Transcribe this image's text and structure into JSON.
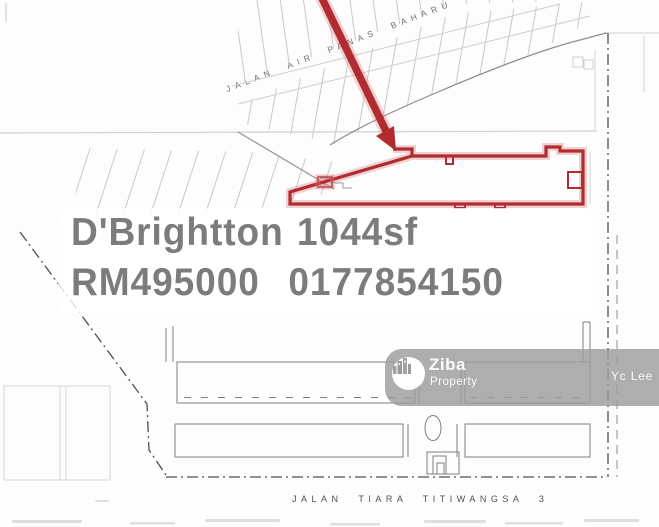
{
  "listing": {
    "name": "D'Brightton",
    "size": "1044sf",
    "price": "RM495000",
    "phone": "0177854150"
  },
  "streets": {
    "top": "JALAN AIR PANAS BAHARU",
    "bottom": "JALAN TIARA TITIWANGSA 3"
  },
  "watermark": {
    "brand": "Ziba",
    "brand_sub": "Property",
    "agent": "Yc Lee",
    "logo_icon": "buildings-icon"
  },
  "colors": {
    "highlight_red": "#b12c31",
    "overlay_text": "#7c7c7c",
    "watermark_bg": "#9c9c9c"
  }
}
